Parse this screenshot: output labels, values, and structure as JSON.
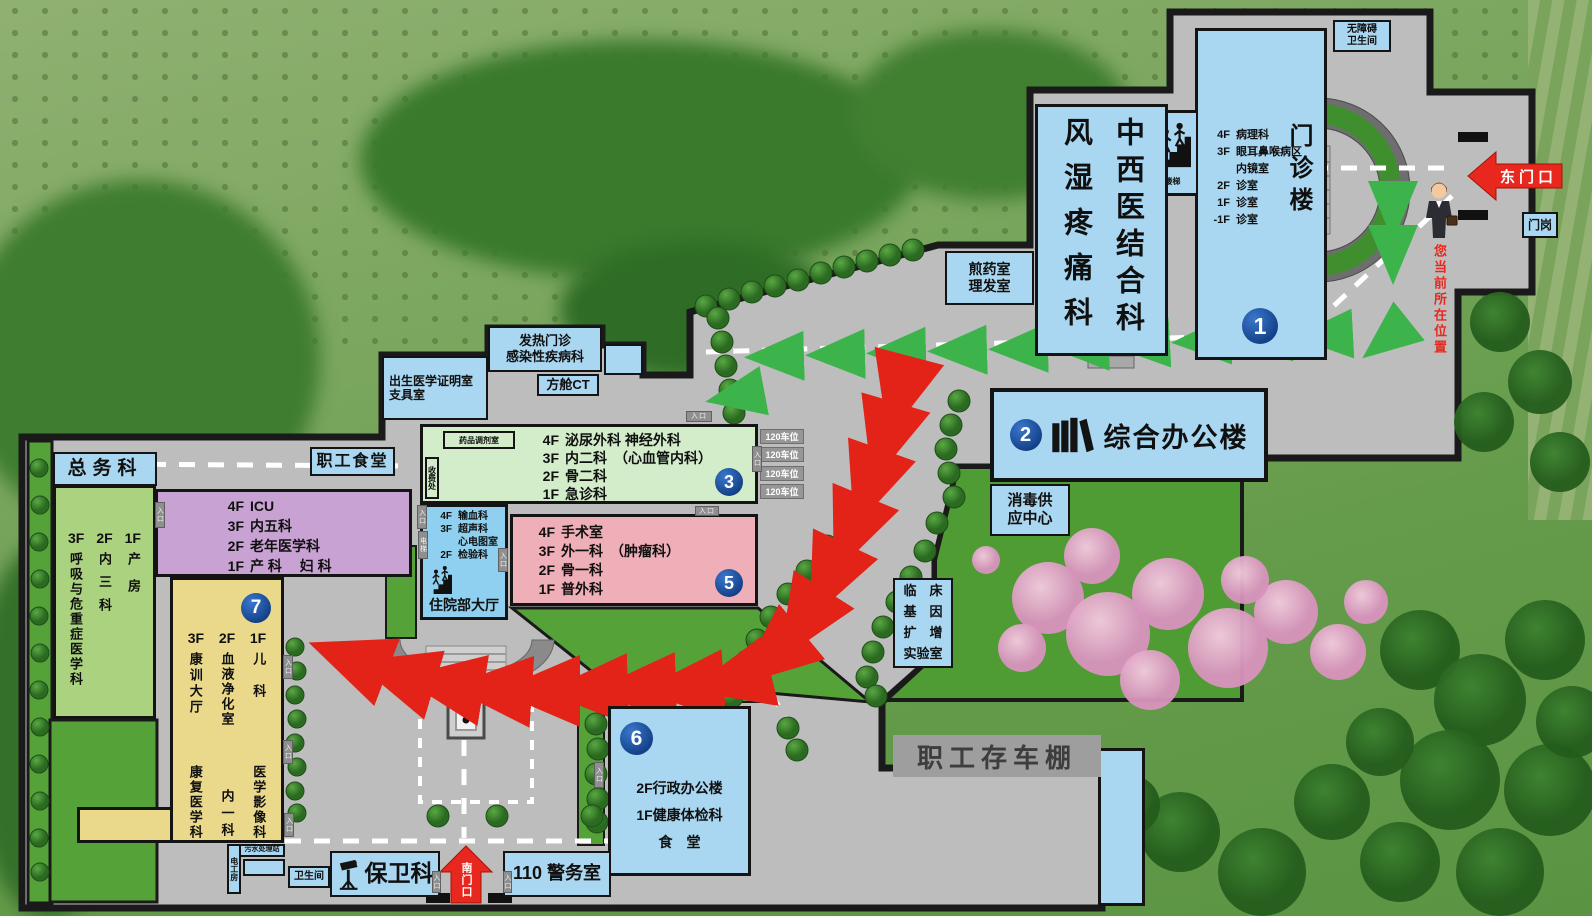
{
  "gates": {
    "east": "东门口",
    "south": "南门口",
    "gate_post": "门岗",
    "you_are_here": "您当前所在位置"
  },
  "common": {
    "entrance": "入口",
    "elevator": "电梯",
    "stairs": "楼梯",
    "parking": "120车位"
  },
  "buildings": {
    "b1": {
      "number": "1",
      "name": "门诊楼",
      "floors": [
        {
          "f": "4F",
          "t": "病理科"
        },
        {
          "f": "3F",
          "t": "眼耳鼻喉病区"
        },
        {
          "f": "",
          "t": "内镜室"
        },
        {
          "f": "2F",
          "t": "诊室"
        },
        {
          "f": "1F",
          "t": "诊室"
        },
        {
          "f": "-1F",
          "t": "诊室"
        }
      ]
    },
    "tcm": {
      "right_col": "中西医结合科",
      "left_col": "风湿疼痛科"
    },
    "b2": {
      "number": "2",
      "name": "综合办公楼"
    },
    "b3": {
      "number": "3",
      "pharmacy": "药品调剂室",
      "cashier": "收费处",
      "floors": [
        {
          "f": "4F",
          "t": "泌尿外科 神经外科"
        },
        {
          "f": "3F",
          "t": "内二科　（心血管内科）"
        },
        {
          "f": "2F",
          "t": "骨二科"
        },
        {
          "f": "1F",
          "t": "急诊科"
        }
      ]
    },
    "hall": {
      "name": "住院部大厅",
      "floors": [
        {
          "f": "4F",
          "t": "输血科"
        },
        {
          "f": "3F",
          "t": "超声科"
        },
        {
          "f": "",
          "t": "心电图室"
        },
        {
          "f": "2F",
          "t": "检验科"
        }
      ]
    },
    "b5": {
      "number": "5",
      "floors": [
        {
          "f": "4F",
          "t": "手术室"
        },
        {
          "f": "3F",
          "t": "外一科　（肿瘤科）"
        },
        {
          "f": "2F",
          "t": "骨一科"
        },
        {
          "f": "1F",
          "t": "普外科"
        }
      ]
    },
    "b6": {
      "number": "6",
      "lines": [
        "2F行政办公楼",
        "1F健康体检科",
        "食　堂"
      ]
    },
    "b7": {
      "number": "7",
      "headers": [
        "3F",
        "2F",
        "1F"
      ],
      "cols": [
        {
          "top": "康训大厅",
          "bottom": "康复医学科"
        },
        {
          "top": "血液净化室",
          "bottom": "内一科"
        },
        {
          "top": "儿　科",
          "bottom": "医学影像科"
        }
      ]
    },
    "purple": {
      "floors": [
        {
          "f": "4F",
          "t": "ICU"
        },
        {
          "f": "3F",
          "t": "内五科"
        },
        {
          "f": "2F",
          "t": "老年医学科"
        },
        {
          "f": "1F",
          "t": "产 科　 妇 科"
        }
      ]
    },
    "west": {
      "headers": [
        "3F",
        "2F",
        "1F"
      ],
      "cols": [
        "呼吸与危重症医学科",
        "内三科",
        "产房"
      ]
    }
  },
  "labels": {
    "general_affairs": "总务科",
    "staff_canteen": "职工食堂",
    "accessible_wc": [
      "无障碍",
      "卫生间"
    ],
    "decoction": [
      "煎药室",
      "理发室"
    ],
    "fever": [
      "发热门诊",
      "感染性疾病科"
    ],
    "cabin_ct": "方舱CT",
    "birth_cert": [
      "出生医学证明室",
      "支具室"
    ],
    "disinfection": [
      "消毒供",
      "应中心"
    ],
    "gene_lab": [
      "临　床",
      "基　因",
      "扩　增",
      "实验室"
    ],
    "bike_shed": "职工存车棚",
    "security": "保卫科",
    "police": "110 警务室",
    "wc": "卫生间",
    "sewage": "污水处理站",
    "electric_room": "电工房"
  }
}
